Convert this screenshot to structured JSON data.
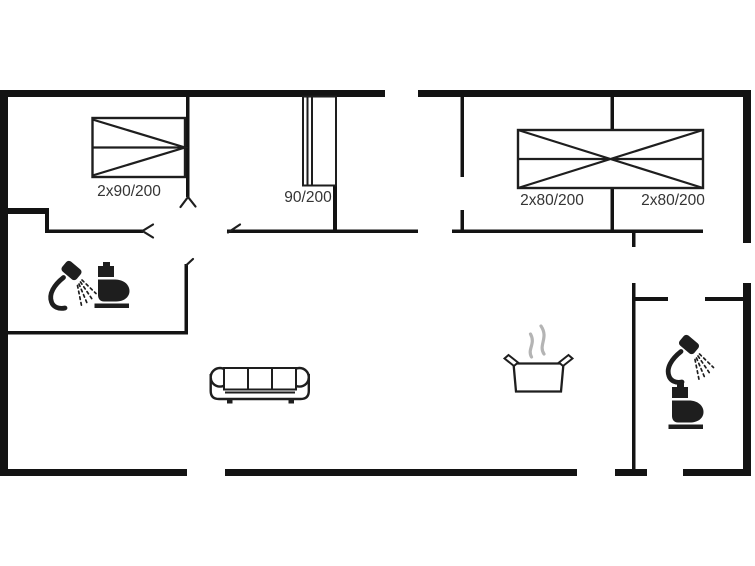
{
  "page": {
    "background": "#ffffff"
  },
  "colors": {
    "wall": "#131313",
    "line": "#1e1e1e",
    "label_text": "#343434",
    "steam": "#b4b4b4",
    "bg": "#ffffff"
  },
  "labels": {
    "bed_double_left": "2x90/200",
    "bed_single_middle": "90/200",
    "bed_double_right_a": "2x80/200",
    "bed_double_right_b": "2x80/200"
  },
  "icons": {
    "left_bathroom": [
      "handheld-shower-icon",
      "toilet-icon"
    ],
    "right_bathroom": [
      "handheld-shower-icon",
      "toilet-icon"
    ],
    "living_room": [
      "sofa-icon"
    ],
    "kitchen": [
      "cooking-pot-steam-icon"
    ]
  }
}
